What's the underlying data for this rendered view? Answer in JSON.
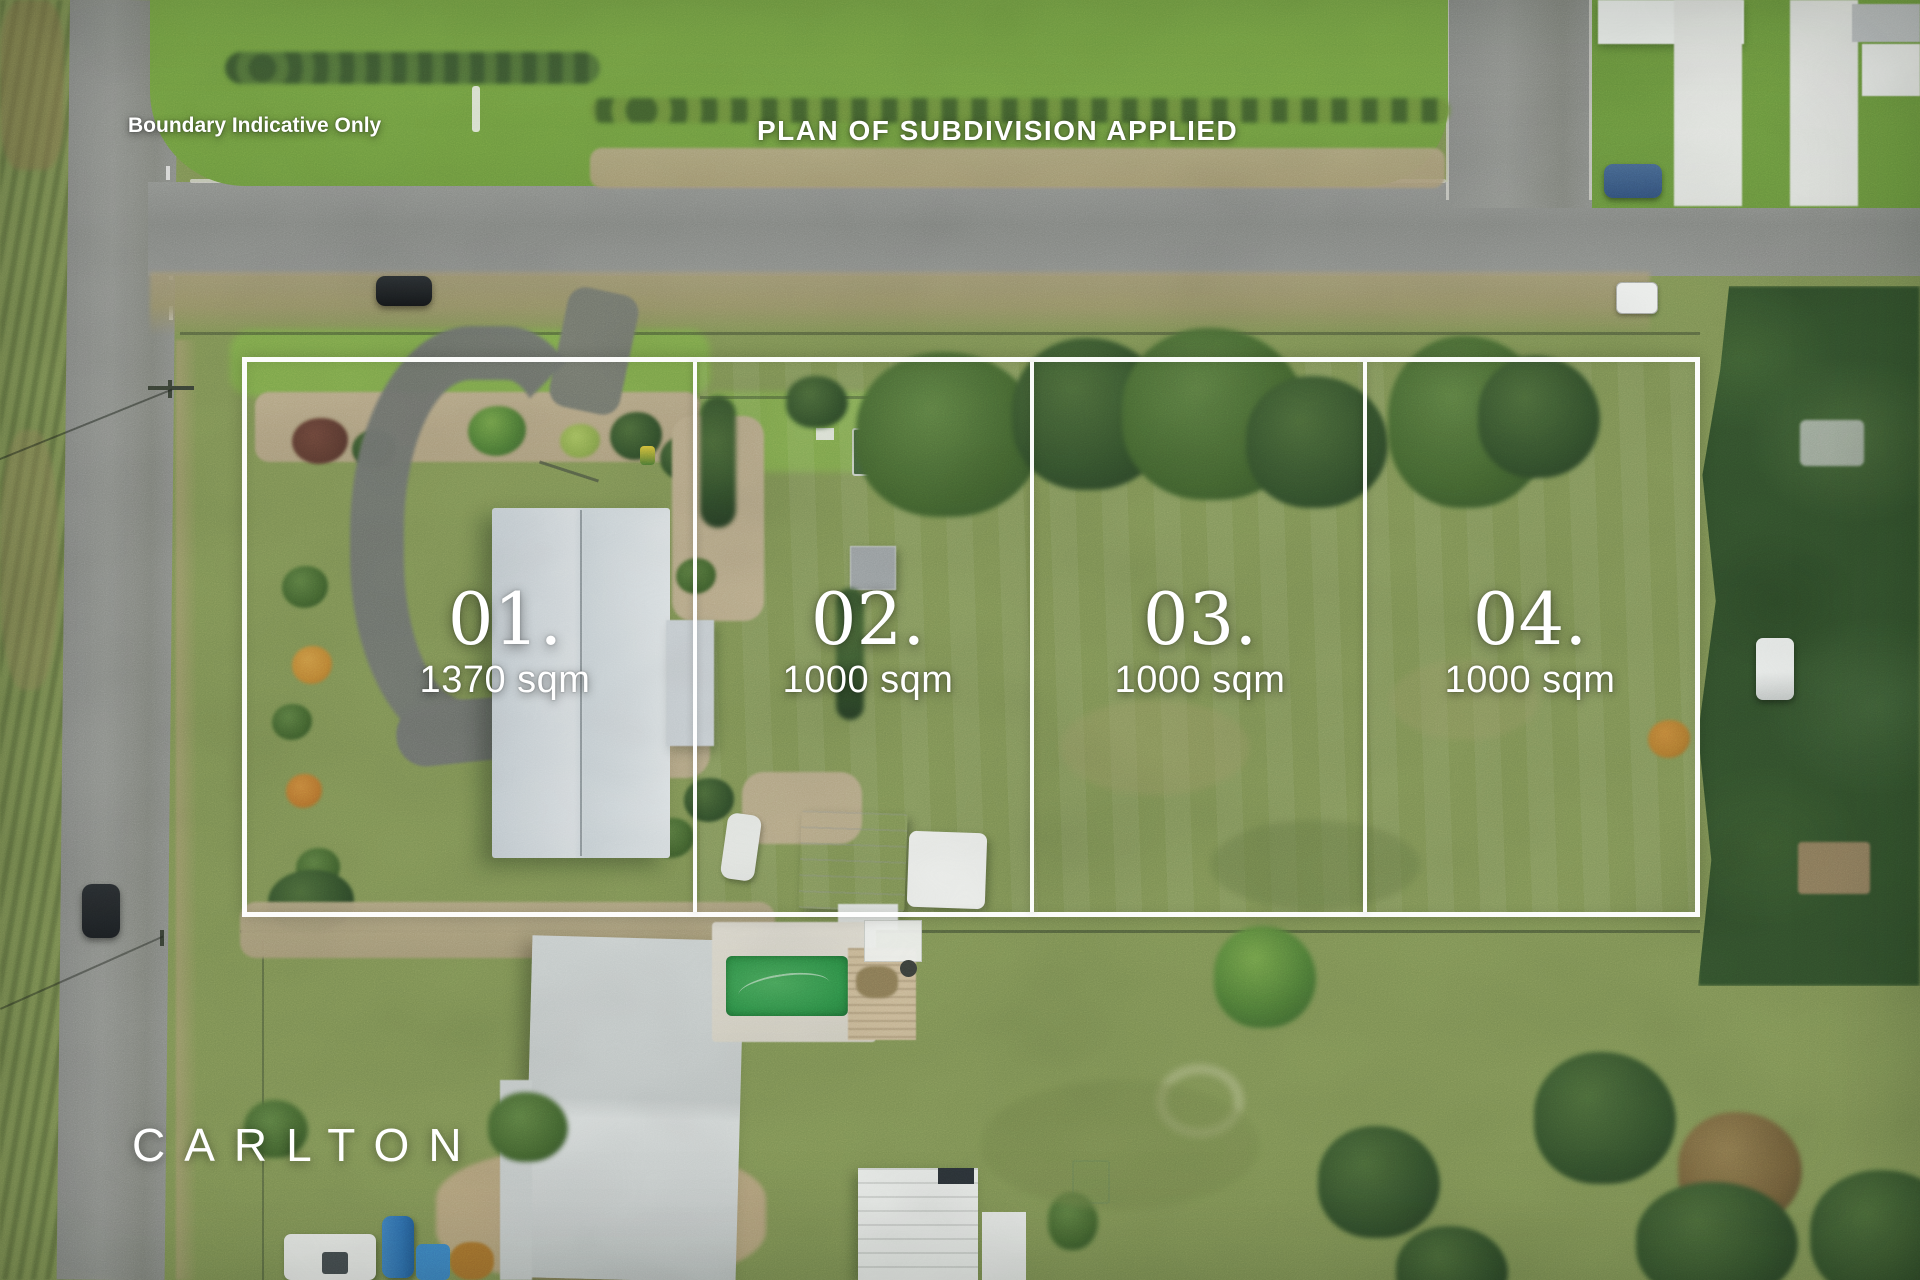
{
  "overlay": {
    "boundary_note": "Boundary Indicative Only",
    "plan_status": "PLAN OF SUBDIVISION APPLIED",
    "brand": "CARLTON"
  },
  "lots": [
    {
      "number": "01.",
      "area": "1370 sqm"
    },
    {
      "number": "02.",
      "area": "1000 sqm"
    },
    {
      "number": "03.",
      "area": "1000 sqm"
    },
    {
      "number": "04.",
      "area": "1000 sqm"
    }
  ],
  "palette": {
    "boundary_line": "#ffffff",
    "label_text": "#ffffff",
    "grass": "#7f9355",
    "road": "#8b8e8a",
    "house_roof": "#ccd4d8",
    "pool_water": "#2f9048"
  }
}
